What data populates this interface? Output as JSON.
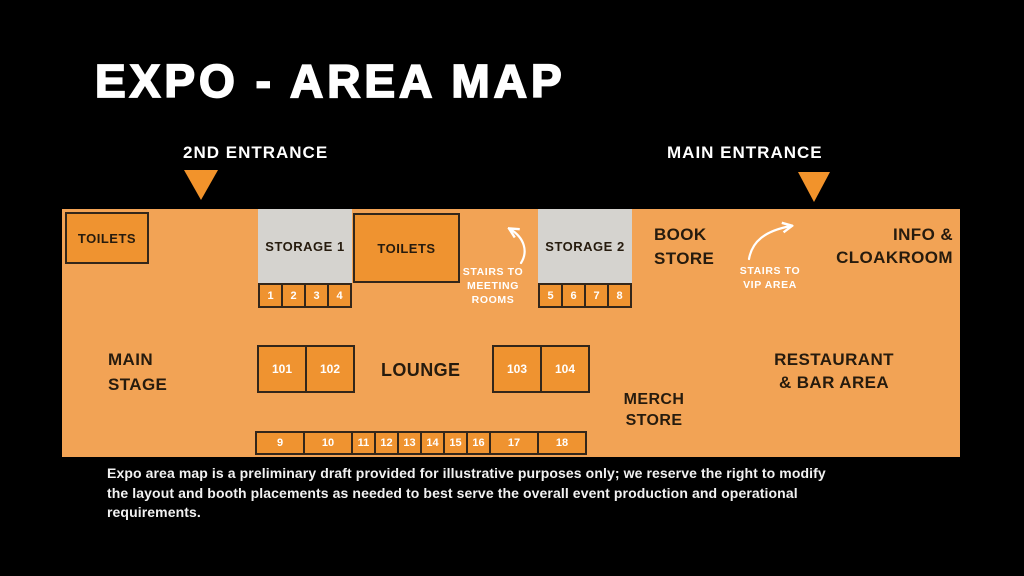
{
  "title": "EXPO - AREA MAP",
  "entrances": {
    "second": "2ND ENTRANCE",
    "main": "MAIN ENTRANCE"
  },
  "colors": {
    "background": "#000000",
    "map_background": "#F2A355",
    "room_orange": "#EF9330",
    "storage_gray": "#D5D3CF",
    "entrance_triangle": "#F2932B",
    "dark_text": "#261B0E",
    "white_text": "#FFFFFF"
  },
  "map": {
    "rooms": {
      "toilets_left": "TOILETS",
      "storage_1": "STORAGE 1",
      "toilets_mid": "TOILETS",
      "storage_2": "STORAGE 2"
    },
    "labels": {
      "main_stage": [
        "MAIN",
        "STAGE"
      ],
      "lounge": "LOUNGE",
      "book_store": [
        "BOOK",
        "STORE"
      ],
      "info_cloakroom": [
        "INFO &",
        "CLOAKROOM"
      ],
      "merch_store": [
        "MERCH",
        "STORE"
      ],
      "restaurant": [
        "RESTAURANT",
        "& BAR AREA"
      ],
      "stairs_meeting": [
        "STAIRS TO",
        "MEETING",
        "ROOMS"
      ],
      "stairs_vip": [
        "STAIRS TO",
        "VIP AREA"
      ]
    },
    "booths_1_4": [
      {
        "label": "1"
      },
      {
        "label": "2"
      },
      {
        "label": "3"
      },
      {
        "label": "4"
      }
    ],
    "booths_5_8": [
      {
        "label": "5"
      },
      {
        "label": "6"
      },
      {
        "label": "7"
      },
      {
        "label": "8"
      }
    ],
    "booths_101_102": [
      {
        "label": "101"
      },
      {
        "label": "102"
      }
    ],
    "booths_103_104": [
      {
        "label": "103"
      },
      {
        "label": "104"
      }
    ],
    "booths_bottom": [
      {
        "label": "9",
        "cls": "wide"
      },
      {
        "label": "10",
        "cls": "wide"
      },
      {
        "label": "11"
      },
      {
        "label": "12"
      },
      {
        "label": "13"
      },
      {
        "label": "14"
      },
      {
        "label": "15"
      },
      {
        "label": "16"
      },
      {
        "label": "17",
        "cls": "wide"
      },
      {
        "label": "18",
        "cls": "wide"
      }
    ]
  },
  "disclaimer": {
    "lines": [
      "Expo area map is a preliminary draft provided for illustrative purposes only; we reserve the right to modify",
      "the layout and booth placements as needed to best serve the overall event production and operational",
      "requirements."
    ]
  }
}
